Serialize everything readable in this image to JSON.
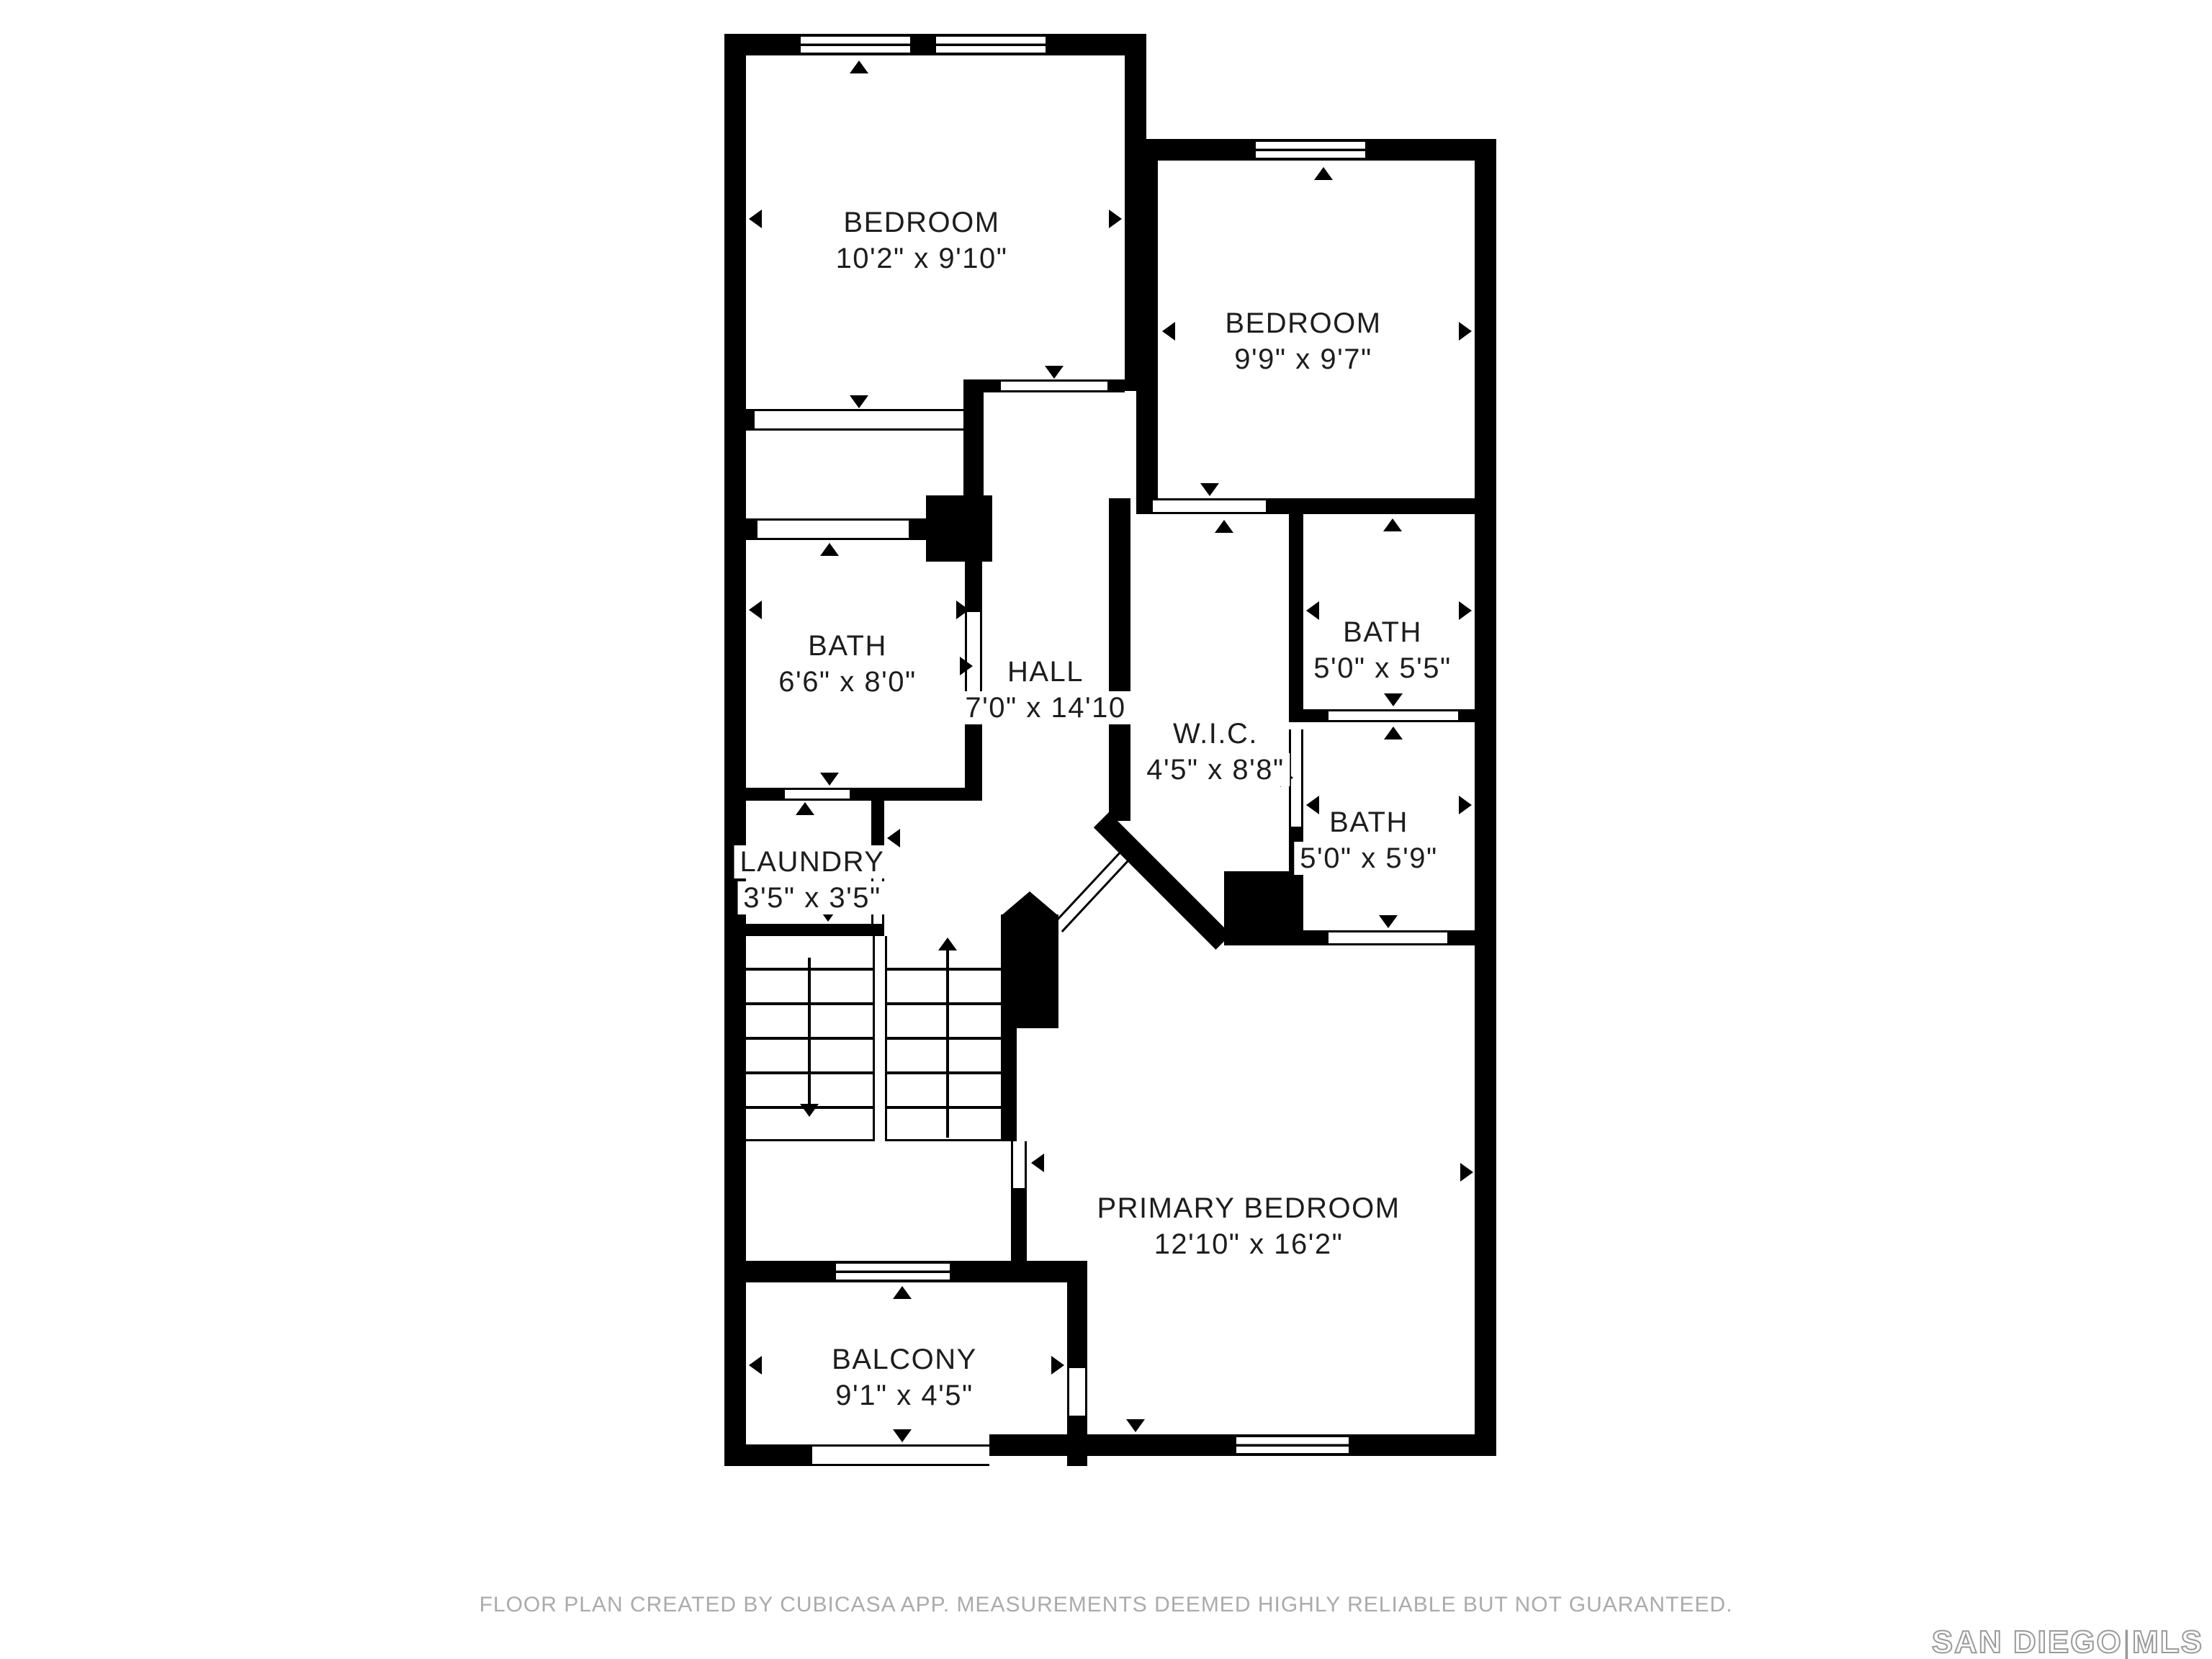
{
  "floor_plan": {
    "rooms": {
      "bedroom1": {
        "name": "BEDROOM",
        "dims": "10'2\" x 9'10\""
      },
      "bedroom2": {
        "name": "BEDROOM",
        "dims": "9'9\" x 9'7\""
      },
      "bath_left": {
        "name": "BATH",
        "dims": "6'6\" x 8'0\""
      },
      "hall": {
        "name": "HALL",
        "dims": "7'0\" x 14'10"
      },
      "wic": {
        "name": "W.I.C.",
        "dims": "4'5\" x 8'8\""
      },
      "bath_upper_right": {
        "name": "BATH",
        "dims": "5'0\" x 5'5\""
      },
      "bath_lower_right": {
        "name": "BATH",
        "dims": "5'0\" x 5'9\""
      },
      "laundry": {
        "name": "LAUNDRY",
        "dims": "3'5\" x 3'5\""
      },
      "primary": {
        "name": "PRIMARY BEDROOM",
        "dims": "12'10\" x 16'2\""
      },
      "balcony": {
        "name": "BALCONY",
        "dims": "9'1\" x 4'5\""
      }
    },
    "footer": {
      "disclaimer": "FLOOR PLAN CREATED BY CUBICASA APP. MEASUREMENTS DEEMED HIGHLY RELIABLE BUT NOT GUARANTEED."
    },
    "brand": {
      "name_left": "SAN DIEGO",
      "separator": "|",
      "name_right": "MLS"
    },
    "colors": {
      "wall": "#000000",
      "label_text": "#1d1d1f",
      "footer_text": "#ababab",
      "logo_gray": "#9a9a9a"
    },
    "icons": {
      "door_direction_marker": "black-triangle",
      "stairs_down_arrow": "down-arrow",
      "stairs_up_arrow": "up-arrow",
      "window_symbol": "framed-window"
    }
  }
}
